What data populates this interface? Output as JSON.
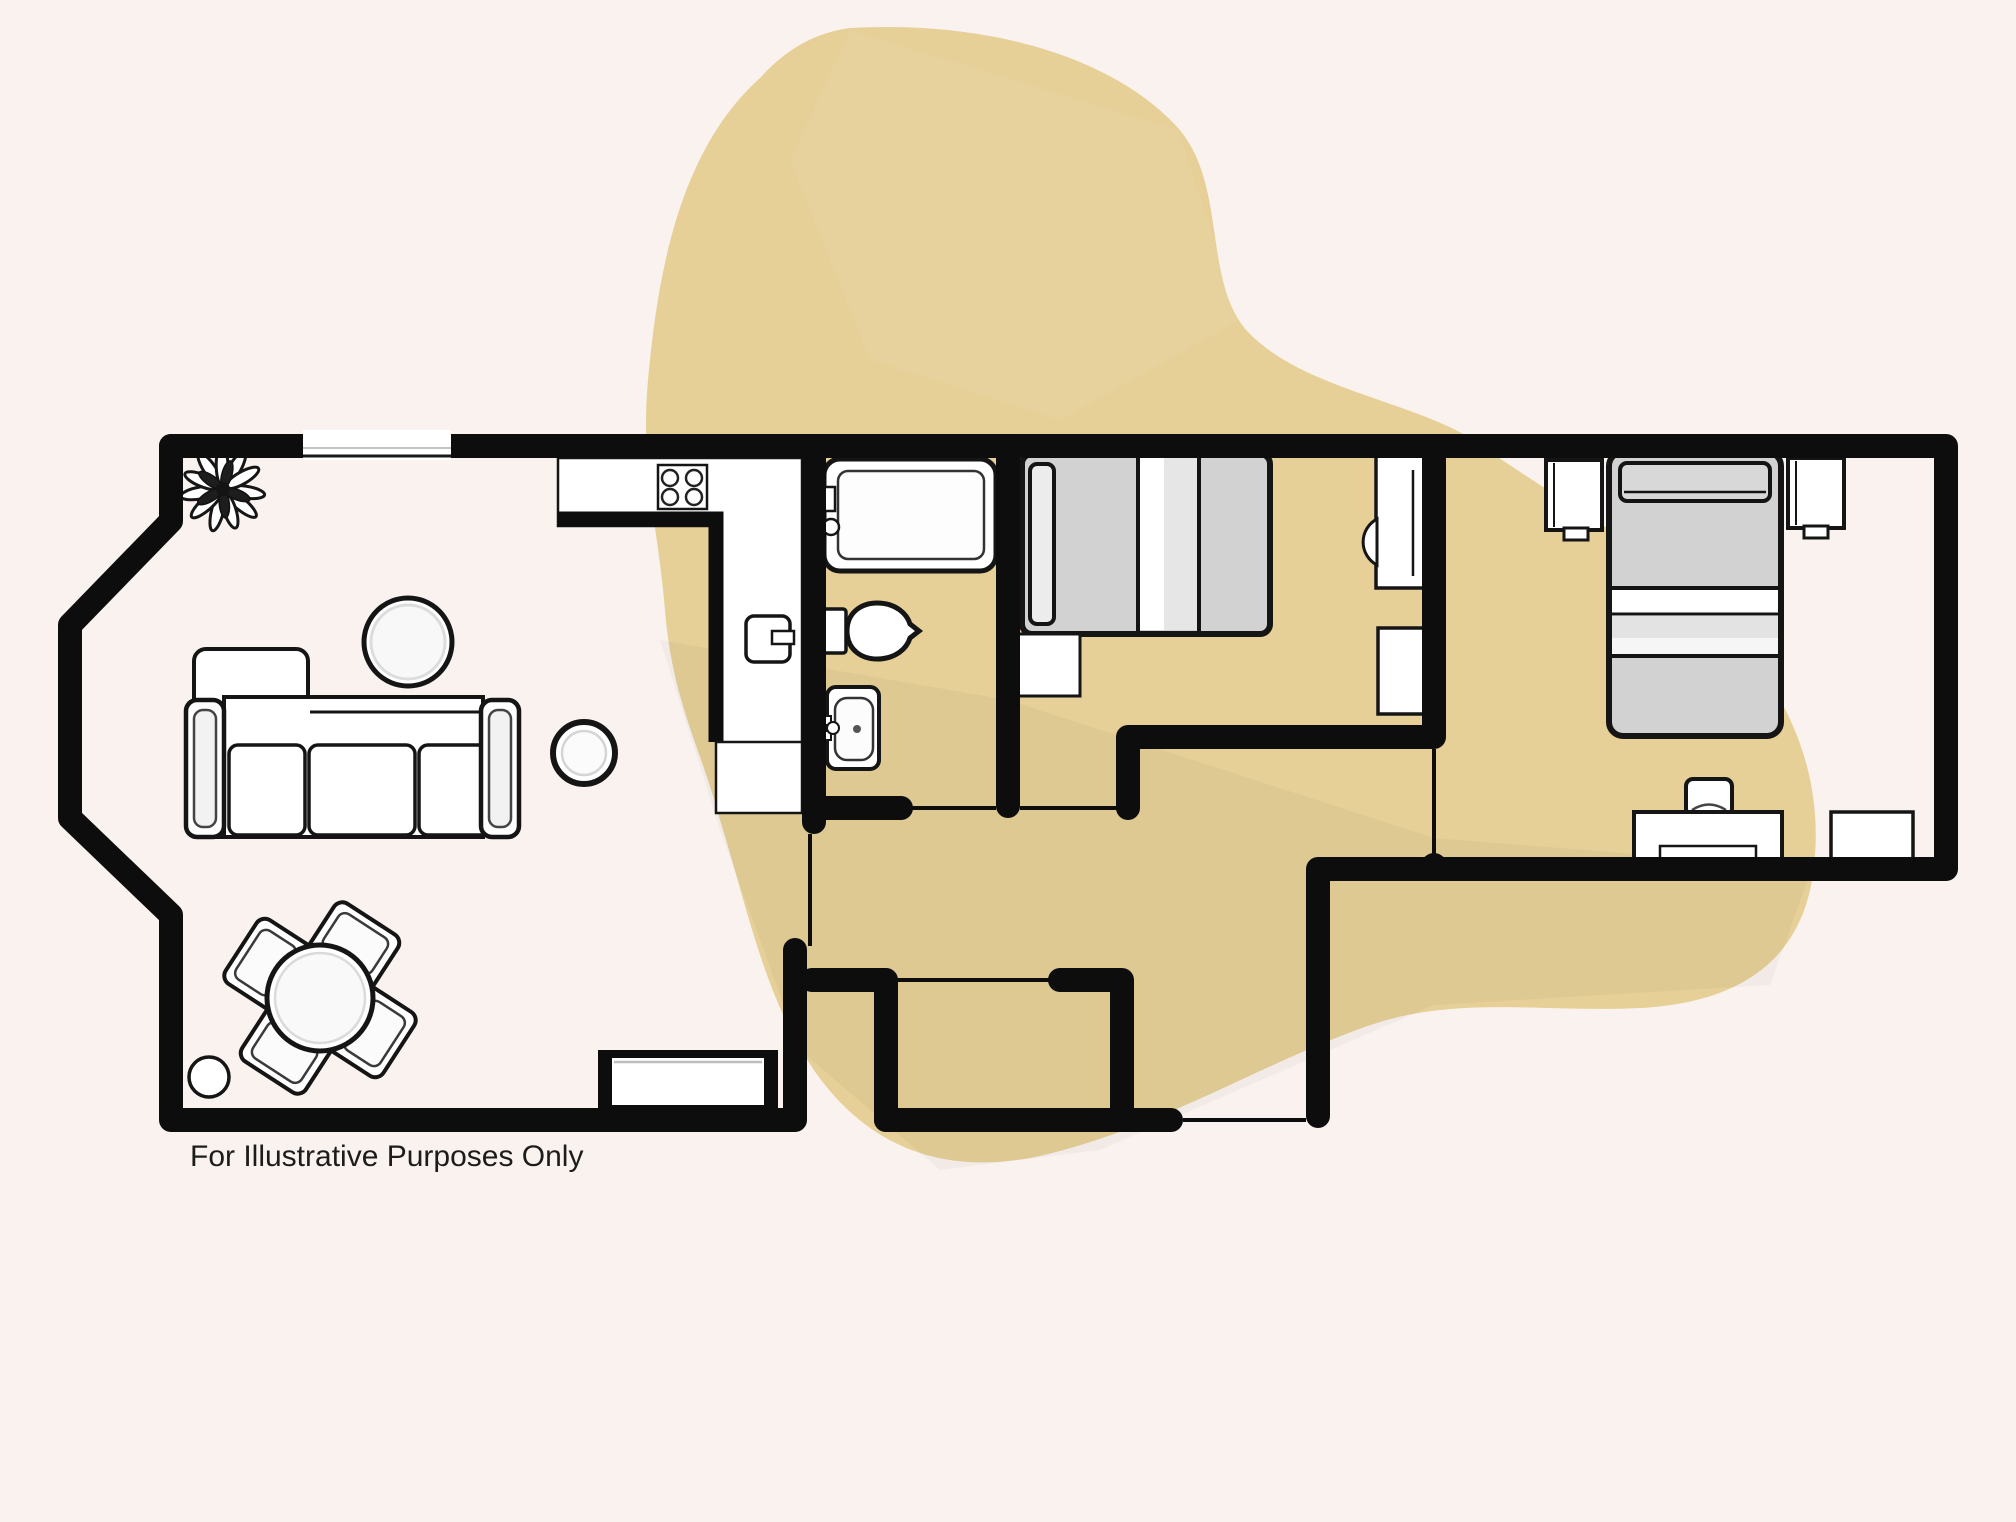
{
  "footer": {
    "disclaimer": "For Illustrative Purposes Only"
  },
  "theme": {
    "background": "#faf2ee",
    "blob": "#e6d098",
    "wall": "#0d0d0d",
    "furniture_fill": "#ffffff",
    "furniture_stroke": "#151515",
    "mattress_gray": "#d2d2d2",
    "text_color": "#1c1c1c"
  },
  "plan": {
    "type": "apartment-floor-plan",
    "rooms": [
      {
        "name": "living-dining-room",
        "features": [
          "potted-plant",
          "top-window",
          "coffee-table",
          "sectional-sofa-with-chaise",
          "side-table",
          "round-dining-table",
          "four-dining-chairs",
          "stool",
          "bottom-window-bay"
        ]
      },
      {
        "name": "kitchen",
        "features": [
          "l-shaped-counter",
          "four-ring-hob",
          "counter-appliance-sink"
        ]
      },
      {
        "name": "bathroom",
        "features": [
          "bathtub",
          "toilet",
          "wash-basin"
        ]
      },
      {
        "name": "bedroom-1",
        "features": [
          "double-bed",
          "bedside-table",
          "desk-with-chair",
          "cabinet"
        ]
      },
      {
        "name": "bedroom-2",
        "features": [
          "double-bed",
          "nightstand-left",
          "nightstand-right",
          "desk-with-chair",
          "cabinet"
        ]
      },
      {
        "name": "hallway",
        "features": [
          "closet",
          "front-door-opening"
        ]
      }
    ],
    "door_lines": 6,
    "windows": 2
  }
}
